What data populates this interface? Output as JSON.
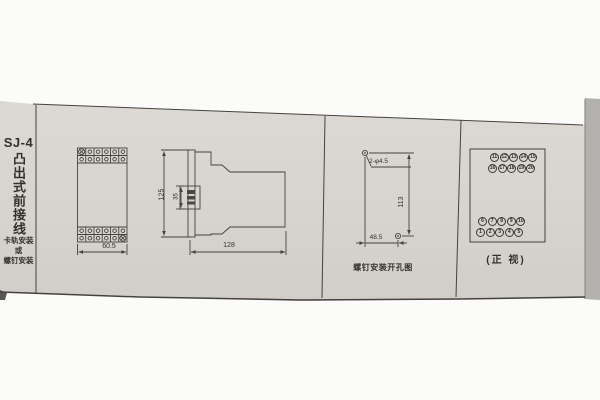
{
  "left_column": {
    "model": "SJ-4",
    "vertical_title": "凸出式前接线",
    "note_lines": [
      "卡轨安装",
      "或",
      "螺钉安装"
    ]
  },
  "front_view": {
    "width_dim": "60.5"
  },
  "side_view": {
    "height_dim": "125",
    "clip_dim": "35",
    "depth_dim": "128"
  },
  "drill_view": {
    "hole_label": "2-φ4.5",
    "height_dim": "113",
    "width_dim": "48.5",
    "caption": "螺钉安装开孔图"
  },
  "terminal_view": {
    "rows": [
      [
        "11",
        "12",
        "13",
        "14",
        "15"
      ],
      [
        "16",
        "17",
        "18",
        "19",
        "20"
      ],
      [
        "6",
        "7",
        "8",
        "9",
        "10"
      ],
      [
        "1",
        "2",
        "3",
        "4",
        "5"
      ]
    ],
    "caption": "(正 视)"
  },
  "colors": {
    "paper": "#d8d5d0",
    "line": "#45423e",
    "ink": "#2e2c29"
  }
}
